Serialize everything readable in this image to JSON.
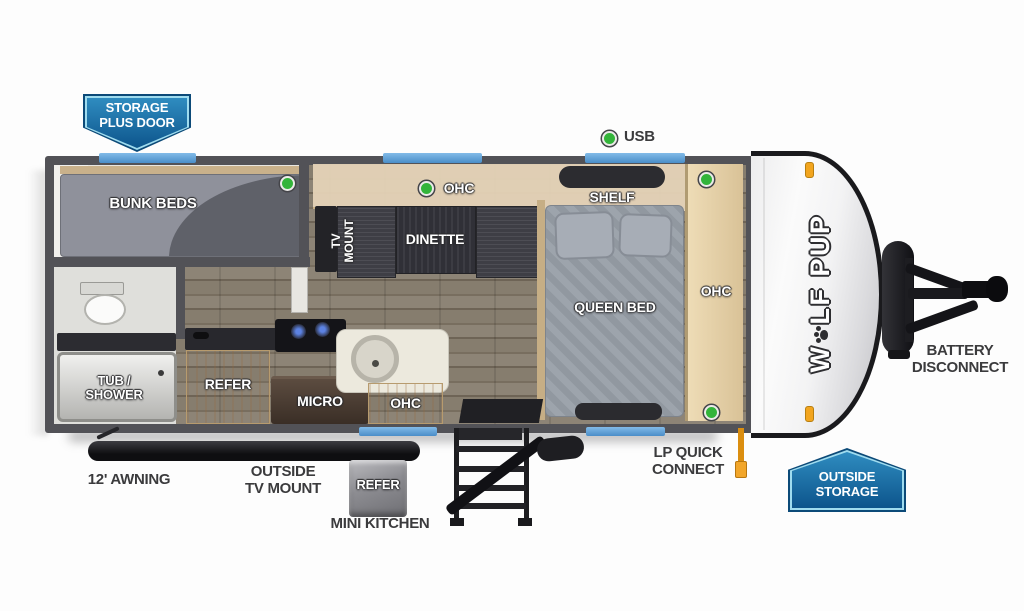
{
  "brand": {
    "pre": "W",
    "post": "LF PUP"
  },
  "badges": {
    "storage_plus_door": [
      "STORAGE",
      "PLUS DOOR"
    ],
    "outside_storage": [
      "OUTSIDE",
      "STORAGE"
    ],
    "outside_refer": "REFER",
    "mini_kitchen": "MINI KITCHEN"
  },
  "callouts": {
    "usb": "USB",
    "battery_disconnect": [
      "BATTERY",
      "DISCONNECT"
    ],
    "lp_quick_connect": [
      "LP QUICK",
      "CONNECT"
    ],
    "awning": "12' AWNING",
    "outside_tv_mount": [
      "OUTSIDE",
      "TV MOUNT"
    ]
  },
  "rooms": {
    "bunk_beds": "BUNK BEDS",
    "tv_mount": [
      "TV",
      "MOUNT"
    ],
    "ohc_dinette": "OHC",
    "dinette": "DINETTE",
    "shelf": "SHELF",
    "queen_bed": "QUEEN BED",
    "ohc_bedroom": "OHC",
    "tub_shower": [
      "TUB /",
      "SHOWER"
    ],
    "refer": "REFER",
    "micro": "MICRO",
    "ohc_kitchen": "OHC"
  },
  "colors": {
    "badge_blue_top": "#2f8cc0",
    "badge_blue_bottom": "#0d558c",
    "badge_border": "#9fdcef",
    "window_blue": "#5b9ed6",
    "indicator_green": "#33b43a",
    "wall_gray": "#525257",
    "wood_cabinet": "#d8bd92",
    "label_dark": "#3b3b3d",
    "lp_orange": "#e8940a"
  }
}
